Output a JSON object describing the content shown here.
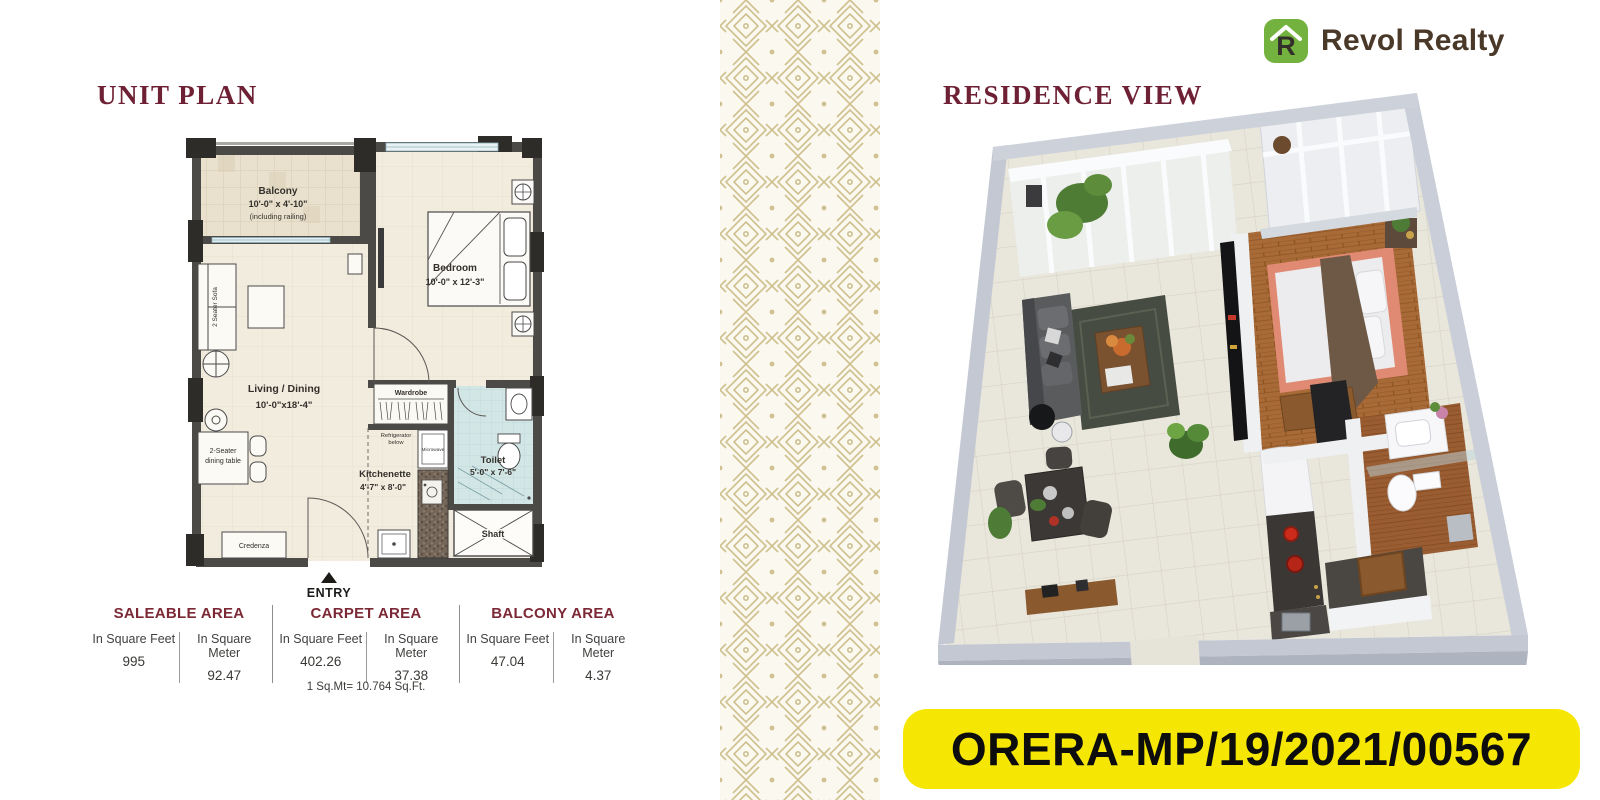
{
  "unit_plan": {
    "title": "UNIT PLAN",
    "entry_label": "ENTRY",
    "rooms": {
      "balcony": {
        "name": "Balcony",
        "dim": "10'-0\" x 4'-10\"",
        "note": "(including railing)"
      },
      "bedroom": {
        "name": "Bedroom",
        "dim": "10'-0\" x 12'-3\""
      },
      "living": {
        "name": "Living / Dining",
        "dim": "10'-0\"x18'-4\""
      },
      "kitchenette": {
        "name": "Kitchenette",
        "dim": "4'-7\" x 8'-0\""
      },
      "toilet": {
        "name": "Toilet",
        "dim": "5'-0\" x 7'-6\""
      },
      "wardrobe": "Wardrobe",
      "shaft": "Shaft"
    },
    "furniture": {
      "sofa": "2 Seater Sofa",
      "dining_line1": "2-Seater",
      "dining_line2": "dining table",
      "credenza": "Credenza",
      "fridge_line1": "Refrigerator",
      "fridge_line2": "below",
      "microwave": "Microwave"
    },
    "area_table": {
      "groups": [
        {
          "title": "SALEABLE AREA",
          "cols": [
            {
              "label": "In Square Feet",
              "value": "995"
            },
            {
              "label": "In Square Meter",
              "value": "92.47"
            }
          ]
        },
        {
          "title": "CARPET AREA",
          "cols": [
            {
              "label": "In Square Feet",
              "value": "402.26"
            },
            {
              "label": "In Square Meter",
              "value": "37.38"
            }
          ]
        },
        {
          "title": "BALCONY AREA",
          "cols": [
            {
              "label": "In Square Feet",
              "value": "47.04"
            },
            {
              "label": "In Square Meter",
              "value": "4.37"
            }
          ]
        }
      ],
      "note": "1 Sq.Mt= 10.764 Sq.Ft."
    }
  },
  "residence_view": {
    "title": "RESIDENCE VIEW"
  },
  "brand": {
    "logo_text": "Revol Realty",
    "logo_letter": "R"
  },
  "rera": {
    "number": "ORERA-MP/19/2021/00567"
  },
  "colors": {
    "heading_maroon": "#6e2134",
    "badge_yellow": "#f6e604",
    "logo_green": "#74b23f",
    "logo_brown": "#4a3829",
    "pattern_gold": "#cfc08f"
  }
}
